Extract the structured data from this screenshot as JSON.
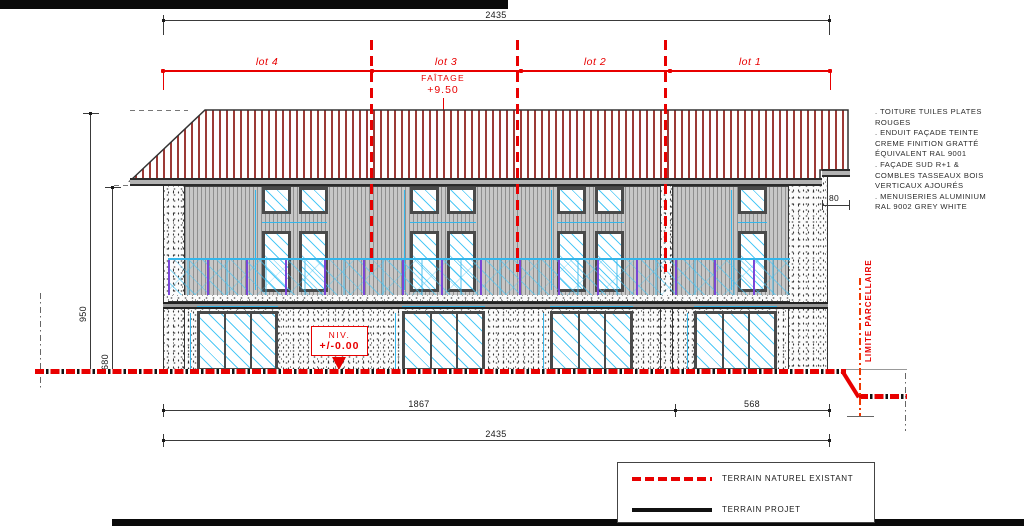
{
  "drawing": {
    "ridge_label": "FAÎTAGE",
    "ridge_level": "+9.50",
    "level_label": "NIV.",
    "level_value": "+/-0.00",
    "parcel_limit_label": "LIMITE PARCELLAIRE"
  },
  "lots": [
    {
      "label": "lot 4"
    },
    {
      "label": "lot 3"
    },
    {
      "label": "lot 2"
    },
    {
      "label": "lot 1"
    }
  ],
  "dimensions": {
    "total_width_top": "2435",
    "building_width": "1867",
    "right_offset": "568",
    "total_width_bottom": "2435",
    "ridge_height": "950",
    "eaves_height": "680",
    "roof_overhang": "80"
  },
  "notes_lines": [
    ". TOITURE TUILES PLATES",
    "ROUGES",
    ". ENDUIT FAÇADE TEINTE",
    "CREME FINITION GRATTÉ",
    "ÉQUIVALENT RAL 9001",
    ". FAÇADE SUD R+1 &",
    "COMBLES TASSEAUX BOIS",
    "VERTICAUX AJOURÉS",
    ". MENUISERIES ALUMINIUM",
    "RAL 9002 GREY WHITE"
  ],
  "legend": {
    "items": [
      {
        "label": "TERRAIN NATUREL EXISTANT",
        "line_style": "red-dashed"
      },
      {
        "label": "TERRAIN PROJET",
        "line_style": "black-solid"
      }
    ]
  },
  "colors": {
    "annotation_red": "#e80000",
    "roof_tile_red": "#9c3a36",
    "glass_cyan": "#46c6f5",
    "railing_purple": "#7a3fd6"
  }
}
